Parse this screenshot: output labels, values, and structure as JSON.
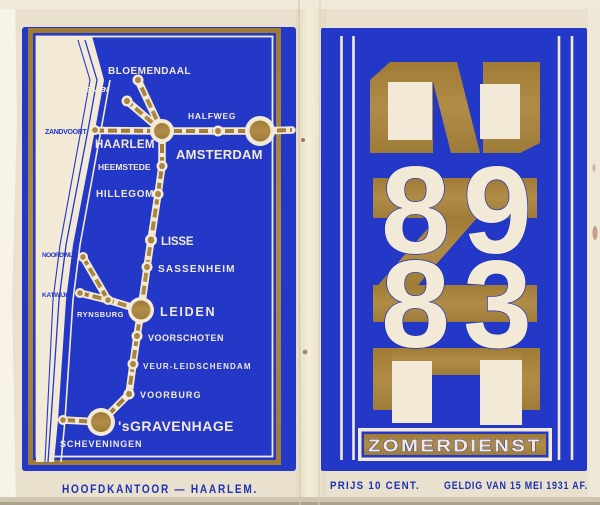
{
  "document_type": "timetable-booklet-cover",
  "colors": {
    "paper": "#e9e1cd",
    "paper_light": "#f6f2e6",
    "blue": "#2438c8",
    "ink_blue": "#1d31b5",
    "gold": "#a9843e",
    "cream": "#f2ead7"
  },
  "left_page": {
    "caption": "HOOFDKANTOOR — HAARLEM.",
    "map": {
      "stations": [
        "BLOEMENDAAL",
        "OVERVEEN",
        "HALFWEG",
        "ZANDVOORT",
        "HAARLEM",
        "AMSTERDAM",
        "HEEMSTEDE",
        "HILLEGOM",
        "LISSE",
        "SASSENHEIM",
        "NOORDWIJK",
        "KATWIJK",
        "RYNSBURG",
        "LEIDEN",
        "VOORSCHOTEN",
        "VEUR-LEIDSCHENDAM",
        "VOORBURG",
        "'sGRAVENHAGE",
        "SCHEVENINGEN"
      ]
    }
  },
  "right_page": {
    "monogram": "NZH",
    "numerals": [
      "8",
      "9",
      "8",
      "3"
    ],
    "banner": "ZOMERDIENST",
    "price": "PRIJS 10 CENT.",
    "validity": "GELDIG VAN 15 MEI 1931 AF."
  }
}
